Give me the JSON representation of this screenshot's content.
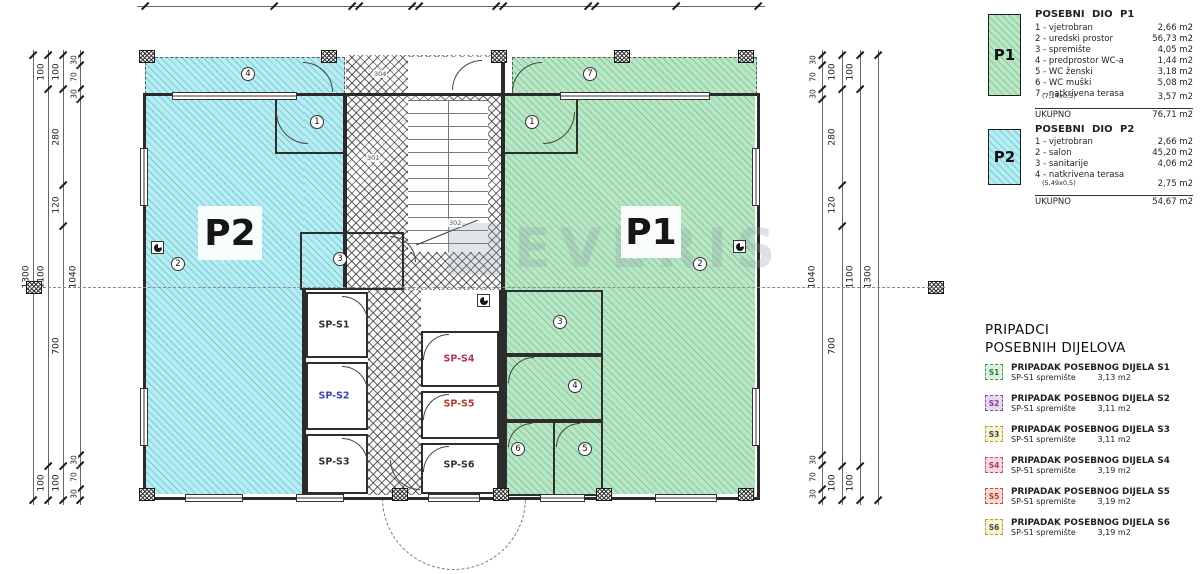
{
  "dims": {
    "c1": [
      "1300"
    ],
    "c2": [
      "100",
      "1100",
      "100"
    ],
    "c3": [
      "100",
      "280",
      "120",
      "700",
      "100"
    ],
    "c4": [
      "30",
      "70",
      "30",
      "1040",
      "30",
      "70",
      "30"
    ]
  },
  "plan": {
    "unit_p1": "P1",
    "unit_p2": "P2",
    "watermark": "EVERIS",
    "storage": [
      "SP-S1",
      "SP-S2",
      "SP-S3",
      "SP-S4",
      "SP-S5",
      "SP-S6"
    ],
    "stair_labels": [
      "304",
      "301",
      "302"
    ],
    "markers_p2": [
      "1",
      "2",
      "3",
      "4"
    ],
    "markers_p1": [
      "1",
      "2",
      "3",
      "4",
      "5",
      "6",
      "7"
    ]
  },
  "legend": {
    "p1": {
      "code": "P1",
      "title": "POSEBNI DIO P1",
      "rows": [
        [
          "1 - vjetrobran",
          "2,66 m2"
        ],
        [
          "2 - uredski prostor",
          "56,73 m2"
        ],
        [
          "3 - spremište",
          "4,05 m2"
        ],
        [
          "4 - predprostor WC-a",
          "1,44 m2"
        ],
        [
          "5 - WC ženski",
          "3,18 m2"
        ],
        [
          "6 - WC muški",
          "5,08 m2"
        ],
        [
          "7 - natkrivena terasa",
          ""
        ]
      ],
      "note": [
        "(7,14x0,5)",
        "3,57 m2"
      ],
      "total": [
        "UKUPNO",
        "76,71 m2"
      ]
    },
    "p2": {
      "code": "P2",
      "title": "POSEBNI DIO P2",
      "rows": [
        [
          "1 - vjetrobran",
          "2,66 m2"
        ],
        [
          "2 - salon",
          "45,20 m2"
        ],
        [
          "3 - sanitarije",
          "4,06 m2"
        ],
        [
          "4 - natkrivena terasa",
          ""
        ]
      ],
      "note": [
        "(5,49x0,5)",
        "2,75 m2"
      ],
      "total": [
        "UKUPNO",
        "54,67 m2"
      ]
    },
    "pripadci": {
      "heading1": "PRIPADCI",
      "heading2": "POSEBNIH DIJELOVA",
      "items": [
        {
          "code": "S1",
          "title": "PRIPADAK POSEBNOG DIJELA S1",
          "name": "SP-S1 spremište",
          "area": "3,13 m2",
          "cls": "sw-s1"
        },
        {
          "code": "S2",
          "title": "PRIPADAK POSEBNOG DIJELA S2",
          "name": "SP-S1 spremište",
          "area": "3,11 m2",
          "cls": "sw-s2"
        },
        {
          "code": "S3",
          "title": "PRIPADAK POSEBNOG DIJELA S3",
          "name": "SP-S1 spremište",
          "area": "3,11 m2",
          "cls": "sw-s3"
        },
        {
          "code": "S4",
          "title": "PRIPADAK POSEBNOG DIJELA S4",
          "name": "SP-S1 spremište",
          "area": "3,19 m2",
          "cls": "sw-s4"
        },
        {
          "code": "S5",
          "title": "PRIPADAK POSEBNOG DIJELA S5",
          "name": "SP-S1 spremište",
          "area": "3,19 m2",
          "cls": "sw-s5"
        },
        {
          "code": "S6",
          "title": "PRIPADAK POSEBNOG DIJELA S6",
          "name": "SP-S1 spremište",
          "area": "3,19 m2",
          "cls": "sw-s6"
        }
      ]
    }
  },
  "colors": {
    "p1_green": "#b9e7c5",
    "p2_cyan": "#b6edf2",
    "s2_violet": "#c0c3ee",
    "s3_yellow": "#f7f3c0",
    "s4_pink": "#e9c9da",
    "s5_red": "#f1c8c0"
  }
}
